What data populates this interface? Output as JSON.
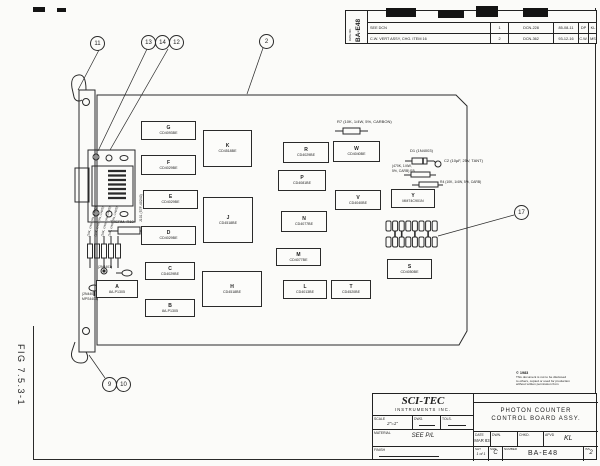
{
  "fig_label": "FIG 7.5.3-1",
  "revision": {
    "doc_vertical_small": "DWG NO.",
    "doc_vertical": "BA-E48",
    "rows": [
      {
        "desc": "SEE DCN",
        "rev": "1",
        "dcn": "DCN-228",
        "date": "85-08-11",
        "by": "DP",
        "app": "KL"
      },
      {
        "desc": "C.W. VERT ASSY, CHG. ITEM 16",
        "rev": "2",
        "dcn": "DCN-362",
        "date": "93-12-16",
        "by": "C.W.",
        "app": "MS"
      }
    ]
  },
  "title_block": {
    "company": "SCI-TEC",
    "company2": "INSTRUMENTS  INC.",
    "next_assembly_label": "NEXT ASSEMBLY",
    "next_assembly": "BA-C01",
    "title_line1": "PHOTON  COUNTER",
    "title_line2": "CONTROL  BOARD  ASSY.",
    "scale_label": "SCALE",
    "scale": "2\"=1\"",
    "dwg_label": "DWG.",
    "tols_label": "TOLS.",
    "material_label": "MATERIAL",
    "material": "SEE  P/L",
    "finish_label": "FINISH",
    "date_label": "DATE",
    "date": "MAR 83",
    "dwn_label": "DWN.",
    "chkd_label": "CHKD.",
    "apvd_label": "APVD",
    "apvd": "KL",
    "sht_label": "SHT",
    "sht": "1 of 1",
    "size_label": "SIZE",
    "size": "C",
    "number_label": "NUMBER",
    "number": "BA-E48",
    "iss_label": "ISS",
    "iss": "2"
  },
  "copyright": {
    "l0": "© 1983",
    "l1": "This document is not to be disclosed",
    "l2": "to others, copied or used for production",
    "l3": "without written permission from",
    "l4": "SCI-TEC Instruments Inc."
  },
  "board": {
    "connector_label": "J101 (57F-40240)",
    "chips": [
      {
        "id": "A",
        "part": "8A-P1305"
      },
      {
        "id": "B",
        "part": "8A-P1305"
      },
      {
        "id": "C",
        "part": "CD4029BE"
      },
      {
        "id": "D",
        "part": "CD4029BE"
      },
      {
        "id": "E",
        "part": "CD4029BE"
      },
      {
        "id": "F",
        "part": "CD4029BE"
      },
      {
        "id": "G",
        "part": "CD4093BE"
      },
      {
        "id": "H",
        "part": "CD4518BE"
      },
      {
        "id": "J",
        "part": "CD4518BE"
      },
      {
        "id": "K",
        "part": "CD4518BE"
      },
      {
        "id": "L",
        "part": "CD4013BE"
      },
      {
        "id": "M",
        "part": "CD4077BE"
      },
      {
        "id": "N",
        "part": "CD4077BE"
      },
      {
        "id": "P",
        "part": "CD4081BE"
      },
      {
        "id": "R",
        "part": "CD4029BE"
      },
      {
        "id": "S",
        "part": "CD4050BE"
      },
      {
        "id": "T",
        "part": "CD4520BE"
      },
      {
        "id": "V",
        "part": "CD4040BE"
      },
      {
        "id": "W",
        "part": "CD4040BE"
      },
      {
        "id": "Y",
        "part": "MM74C901N"
      }
    ],
    "balloons": {
      "b11": "11",
      "b13": "13",
      "b14": "14",
      "b12": "12",
      "b2": "2",
      "b9": "9",
      "b10": "10",
      "b17": "17"
    },
    "labels": {
      "r7": "R7 (10K, 1/4W, 5%, CARBON)",
      "d1": "D1 (1N4003)",
      "c2": "C2 (10µF, 25V, TANT)",
      "r5a": "(470K, 1/4W,",
      "r5b": "5%, CARB) R5",
      "r4": "R4 (10K, 1/4W, 5%, CARB)",
      "therm": "THERM. R10",
      "q1": "(2N4401)",
      "q2a": "(2N4403,",
      "q2b": "MPS4403)",
      "vr": "(10K, 1/4W, 5%, CARB)"
    }
  }
}
